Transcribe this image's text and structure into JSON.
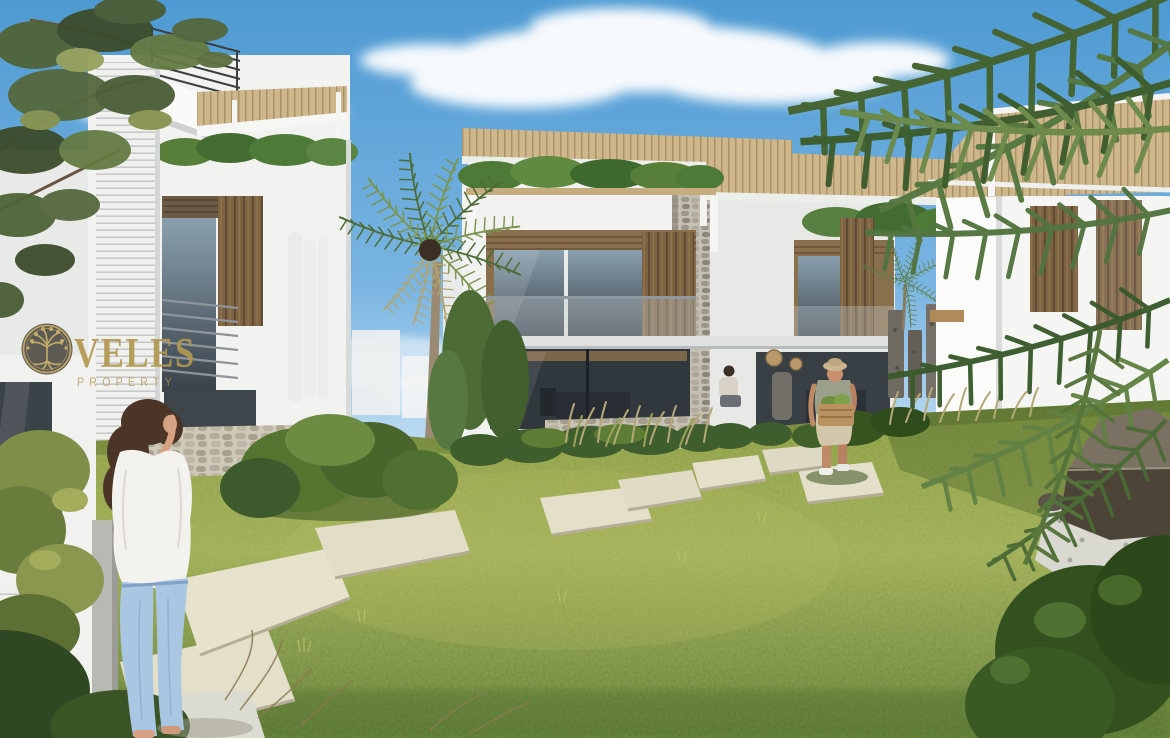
{
  "meta": {
    "type": "architectural-rendering",
    "description": "Marketing render of a modern Mediterranean villa complex: white two-storey villas with wooden slat facades, rooftop pergolas and roof gardens around a shared lawn with a stepping-stone path",
    "width_px": 1170,
    "height_px": 738
  },
  "watermark": {
    "brand": "VELES",
    "subtitle": "PROPERTY",
    "logo": "tree-in-circle-icon",
    "text_color": "#b2974f",
    "emblem_fill": "#514f47",
    "emblem_ring": "#bba05c"
  },
  "scene": {
    "sky": "blue sky with scattered white clouds",
    "buildings": [
      {
        "id": "left-villa",
        "description": "White villa with horizontal louver wall, rooftop metal railing, wood-slat balcony and roof-garden pergola"
      },
      {
        "id": "center-villa",
        "description": "Two-storey white villa with twin rooftop pergolas, roof hedges, stacked-stone column and full-height glazing"
      },
      {
        "id": "right-villa",
        "description": "White villa with timber pergola and vertical wood-slat panels, partly hidden by palm fronds"
      }
    ],
    "figures": [
      {
        "id": "woman",
        "description": "Woman with long brown hair, white blouse and light-blue jeans standing on a concrete pad shielding her eyes"
      },
      {
        "id": "man",
        "description": "Man in a sun hat, tank top and beige shorts carrying a produce basket along the stepping-stone path"
      },
      {
        "id": "interior-person",
        "description": "Seated person visible through the ground-floor glazing"
      }
    ],
    "vegetation": [
      "pine branches top-left",
      "palm tree center",
      "large palm fronds right foreground",
      "roof-garden hedges",
      "shrubs and ornamental grasses",
      "lawn"
    ],
    "hardscape": [
      "stepping-stone path",
      "stone retaining walls",
      "gabion pillars",
      "boulder on white gravel bottom-right"
    ]
  },
  "palette": {
    "sky_top": "#4e9ad2",
    "sky_mid": "#7ab5e2",
    "sky_horizon": "#ddeef8",
    "cloud": "#ffffff",
    "wall_white": "#f2f3f1",
    "wall_bright": "#fbfbfa",
    "wall_shadow": "#dcdedd",
    "louver_line": "#c7c9c8",
    "wood_slat": "#7d6243",
    "wood_slat_dark": "#5e4930",
    "pergola_wood": "#cfb78c",
    "pergola_line": "#ab9168",
    "glass_dark": "#3a4147",
    "glass_light": "#8aa0ae",
    "stone_light": "#cfc9ba",
    "stone_dark": "#97907f",
    "roof_hedge": "#4e7a38",
    "lawn_bright": "#9cab53",
    "lawn_mid": "#87993f",
    "lawn_shadow": "#5d7a33",
    "bush_dark": "#3c5a2b",
    "bush_mid": "#55742f",
    "bush_light": "#6d8c41",
    "palm_green": "#4c6b35",
    "palm_dry": "#b3a470",
    "slab": "#e4dfc9",
    "slab_edge": "#b4ae97",
    "gravel": "#d9d9d2",
    "boulder_lit": "#7a7163",
    "boulder_shade": "#4b4437",
    "skin": "#d7a184",
    "hair_brown": "#4a3526",
    "jeans_blue": "#a9c6e2",
    "blouse_white": "#f4f2ee",
    "hat_tan": "#cbb690",
    "basket_tan": "#b9925f",
    "palm_trunk": "#9a8a72"
  }
}
